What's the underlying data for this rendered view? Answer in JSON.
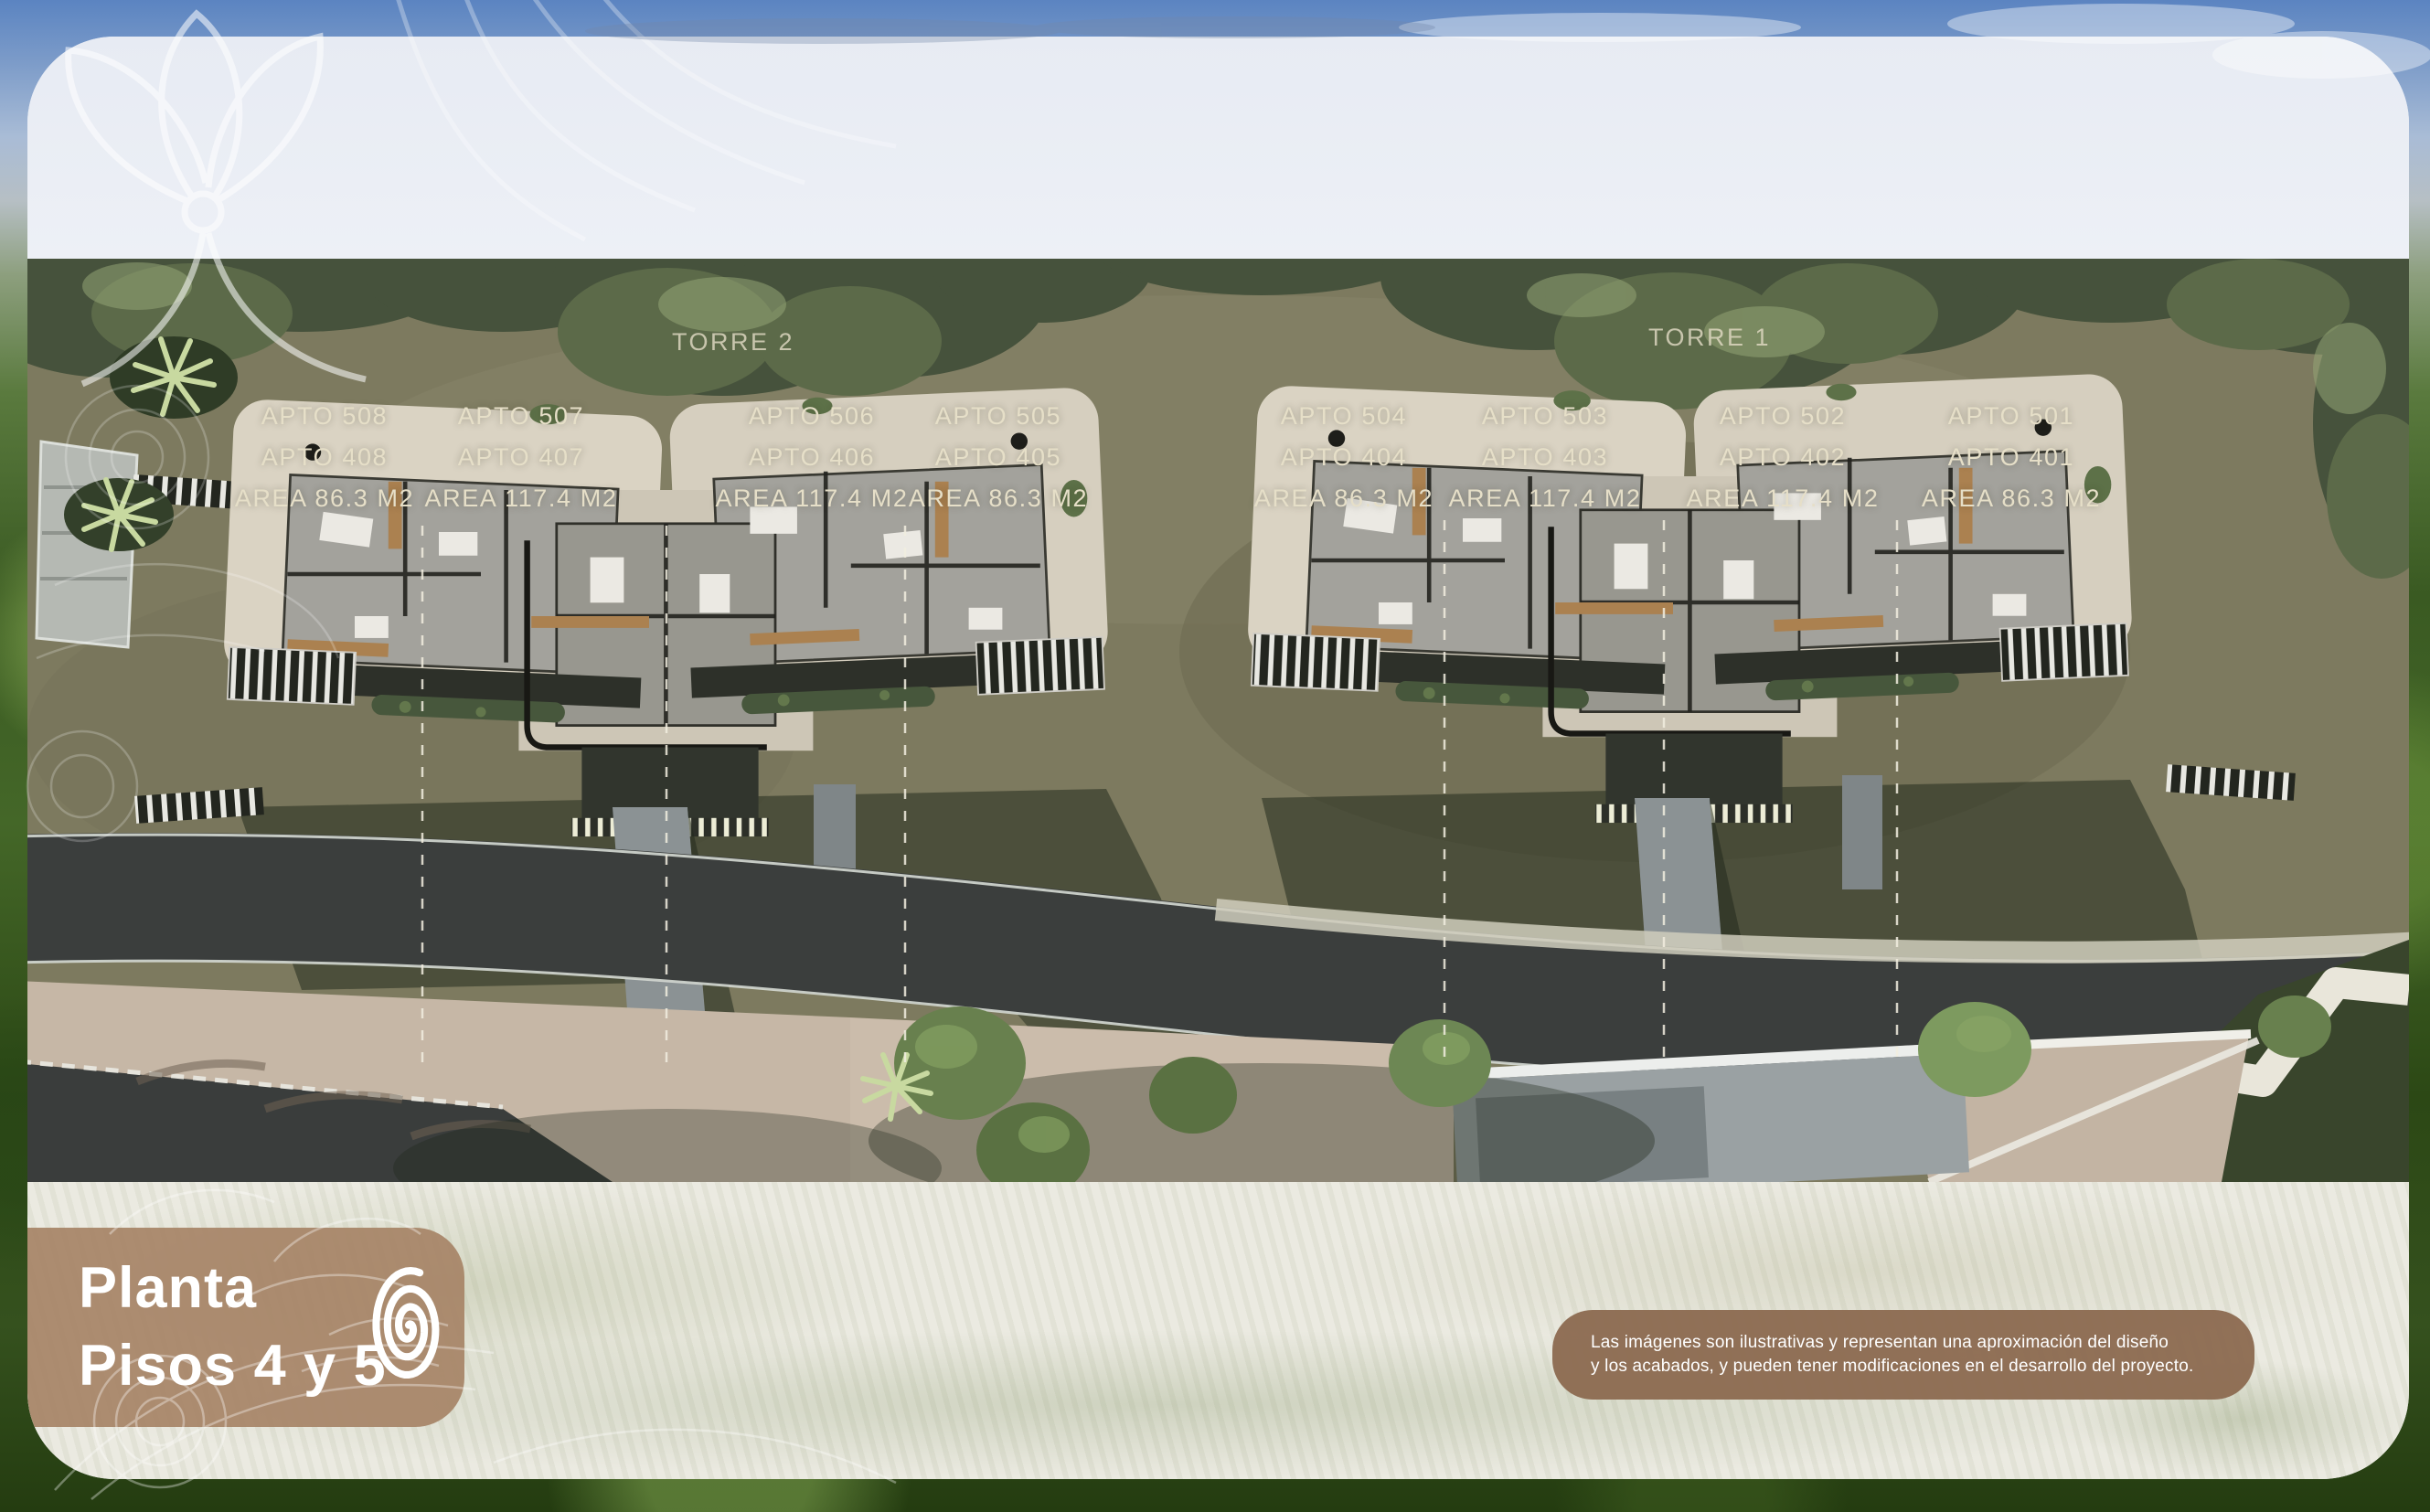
{
  "page": {
    "title_line1": "Planta",
    "title_line2": "Pisos 4 y 5",
    "logo_icon": "spiral-icon",
    "disclaimer_line1": "Las imágenes son ilustrativas y representan una aproximación del diseño",
    "disclaimer_line2": "y los acabados, y pueden tener modificaciones en el desarrollo del proyecto."
  },
  "plan": {
    "towers": [
      {
        "name": "TORRE 2",
        "units": [
          {
            "apto_top": "APTO 508",
            "apto_bottom": "APTO 408",
            "area": "AREA 86.3 M2"
          },
          {
            "apto_top": "APTO 507",
            "apto_bottom": "APTO 407",
            "area": "AREA 117.4 M2"
          },
          {
            "apto_top": "APTO 506",
            "apto_bottom": "APTO 406",
            "area": "AREA 117.4 M2"
          },
          {
            "apto_top": "APTO 505",
            "apto_bottom": "APTO 405",
            "area": "AREA 86.3 M2"
          }
        ]
      },
      {
        "name": "TORRE 1",
        "units": [
          {
            "apto_top": "APTO 504",
            "apto_bottom": "APTO 404",
            "area": "AREA 86.3 M2"
          },
          {
            "apto_top": "APTO 503",
            "apto_bottom": "APTO 403",
            "area": "AREA 117.4 M2"
          },
          {
            "apto_top": "APTO 502",
            "apto_bottom": "APTO 402",
            "area": "AREA 117.4 M2"
          },
          {
            "apto_top": "APTO 501",
            "apto_bottom": "APTO 401",
            "area": "AREA 86.3 M2"
          }
        ]
      }
    ]
  },
  "colors": {
    "title_panel_brown": "#a78467",
    "disclaimer_brown": "#8c6b51",
    "label_cream": "#e6dfc8",
    "card_light": "#e9edf4",
    "ground_olive": "#7d7a5f"
  }
}
